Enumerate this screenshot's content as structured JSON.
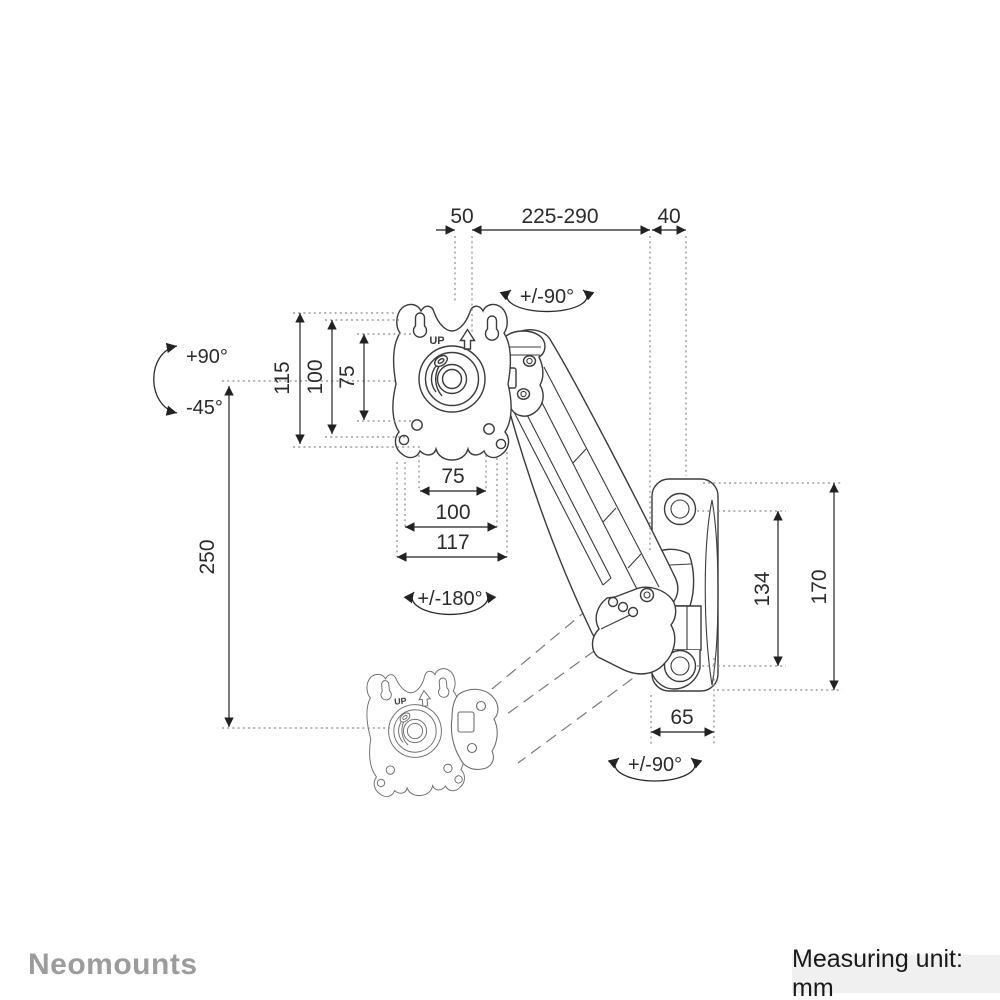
{
  "page": {
    "background": "#ffffff"
  },
  "footer": {
    "brand": "Neomounts",
    "measuring_unit": "Measuring unit: mm",
    "bar_color": "#f0f0f0",
    "brand_color": "#9c9c9c"
  },
  "drawing": {
    "stroke_color": "#3b3b3b",
    "ghost_color": "#7a7a7a",
    "dimension_color": "#222222",
    "plate_marking": "UP"
  },
  "dimensions": {
    "top_offset": "50",
    "arm_reach": "225-290",
    "wall_gap": "40",
    "vesa_height_outer": "115",
    "vesa_height_mid": "100",
    "vesa_height_inner": "75",
    "vertical_range": "250",
    "vesa_width_inner": "75",
    "vesa_width_mid": "100",
    "plate_width": "117",
    "bracket_hole_spacing": "134",
    "bracket_height": "170",
    "bracket_depth": "65"
  },
  "rotations": {
    "swivel_top": "+/-90°",
    "tilt_up": "+90°",
    "tilt_down": "-45°",
    "rotate": "+/-180°",
    "swivel_bottom": "+/-90°"
  }
}
